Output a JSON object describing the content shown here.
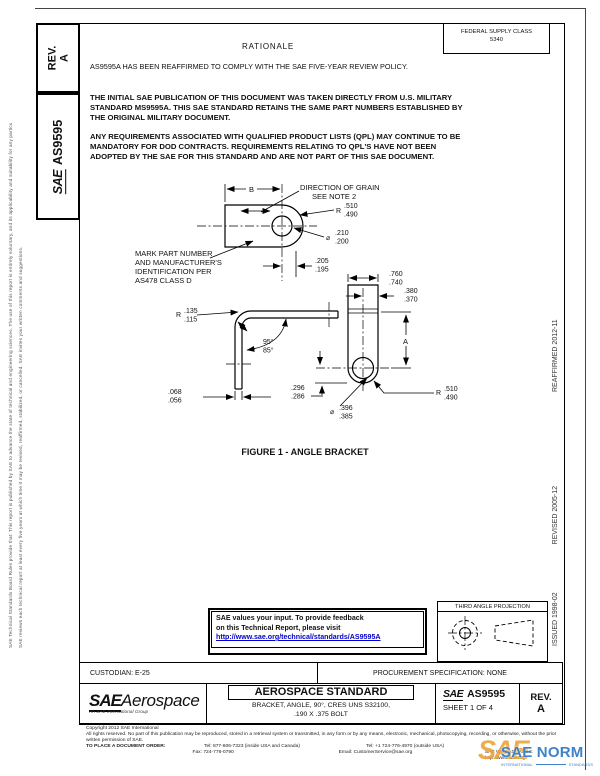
{
  "margins": {
    "left_disclaimer_1": "SAE Technical Standards Board Rules provide that: This report is published by SAE to advance the state of technical and engineering sciences. The use of this report is entirely voluntary, and its applicability and suitability for any particular use, including any patent infringement arising therefrom, is the sole responsibility of the user.",
    "left_disclaimer_2": "SAE reviews each technical report at least every five years at which time it may be revised, reaffirmed, stabilized, or cancelled. SAE invites your written comments and suggestions.",
    "dates": {
      "issued": "ISSUED 1998-02",
      "revised": "REVISED 2005-12",
      "reaffirmed": "REAFFIRMED 2012-11"
    }
  },
  "sidebar": {
    "rev_label": "REV.",
    "rev_value": "A",
    "logo": "SAE",
    "doc_number": "AS9595"
  },
  "header": {
    "fsc_label": "FEDERAL SUPPLY CLASS",
    "fsc_value": "5340",
    "rationale_title": "RATIONALE",
    "rationale_text": "AS9595A HAS BEEN REAFFIRMED TO COMPLY WITH THE SAE FIVE-YEAR REVIEW POLICY.",
    "paragraph1": "THE  INITIAL SAE PUBLICATION OF THIS DOCUMENT WAS TAKEN DIRECTLY FROM  U.S. MILITARY STANDARD MS9595A. THIS SAE STANDARD RETAINS THE SAME PART NUMBERS ESTABLISHED BY THE ORIGINAL MILITARY DOCUMENT.",
    "paragraph2": "ANY REQUIREMENTS ASSOCIATED WITH QUALIFIED PRODUCT LISTS (QPL) MAY CONTINUE TO BE MANDATORY FOR DOD CONTRACTS.  REQUIREMENTS RELATING TO QPL'S HAVE NOT BEEN ADOPTED BY THE SAE FOR THIS STANDARD AND ARE NOT PART OF THIS SAE DOCUMENT."
  },
  "figure": {
    "caption": "FIGURE 1 - ANGLE BRACKET",
    "notes": {
      "grain_line1": "DIRECTION OF GRAIN",
      "grain_line2": "SEE NOTE 2",
      "mark1": "MARK PART NUMBER",
      "mark2": "AND MANUFACTURER'S",
      "mark3": "IDENTIFICATION PER",
      "mark4": "AS478  CLASS D"
    },
    "dims": {
      "b": "B",
      "a": "A",
      "r_sym": "R",
      "dia_sym": "⌀",
      "end_radius_max": ".510",
      "end_radius_min": ".490",
      "small_hole_max": ".210",
      "small_hole_min": ".200",
      "hole_edge_max": ".205",
      "hole_edge_min": ".195",
      "leg_width_max": ".760",
      "leg_width_min": ".740",
      "hole_offset_max": ".380",
      "hole_offset_min": ".370",
      "bend_radius_max": ".135",
      "bend_radius_min": ".115",
      "angle_max": "95°",
      "angle_min": "85°",
      "thickness_max": ".068",
      "thickness_min": ".056",
      "hole_end_max": ".296",
      "hole_end_min": ".286",
      "large_hole_max": ".396",
      "large_hole_min": ".385"
    }
  },
  "feedback": {
    "line1": "SAE values your input. To provide feedback",
    "line2": "on this Technical Report, please visit",
    "link": "http://www.sae.org/technical/standards/AS9595A",
    "link_color": "#0000cc"
  },
  "projection": {
    "title": "THIRD ANGLE PROJECTION"
  },
  "title_block": {
    "custodian": "CUSTODIAN: E-25",
    "procurement": "PROCUREMENT SPECIFICATION: NONE",
    "logo_sae": "SAE",
    "logo_aerospace": "Aerospace",
    "logo_tagline": "An SAE International Group",
    "doc_type": "AEROSPACE STANDARD",
    "title_line1": "BRACKET, ANGLE, 90°, CRES UNS S32100,",
    "title_line2": ".190 X .375 BOLT",
    "number_logo": "SAE",
    "number": "AS9595",
    "sheet": "SHEET 1 OF 4",
    "rev_label": "REV.",
    "rev_value": "A"
  },
  "footer": {
    "copyright": "Copyright 2012 SAE International",
    "rights": "All rights reserved. No part of this publication may be reproduced, stored in a retrieval system or transmitted, in any form or by any means, electronic, mechanical, photocopying, recording, or otherwise, without the prior written permission of SAE.",
    "order_label": "TO PLACE A DOCUMENT ORDER:",
    "tel_inside": "Tel: 877-606-7323 (inside USA and Canada)",
    "tel_outside": "Tel: +1 724-776-4970 (outside USA)",
    "fax": "Fax: 724-776-0790",
    "email": "Email: CustomerService@sae.org",
    "web": "SAE WEB ADDRESS: http://www.sae.org"
  },
  "watermark": {
    "logo": "SAE",
    "name": "SAE NORM",
    "sub_left": "INTERNATIONAL",
    "sub_right": "STANDARDS",
    "blue": "#3e83c9",
    "orange": "#eca43c"
  }
}
